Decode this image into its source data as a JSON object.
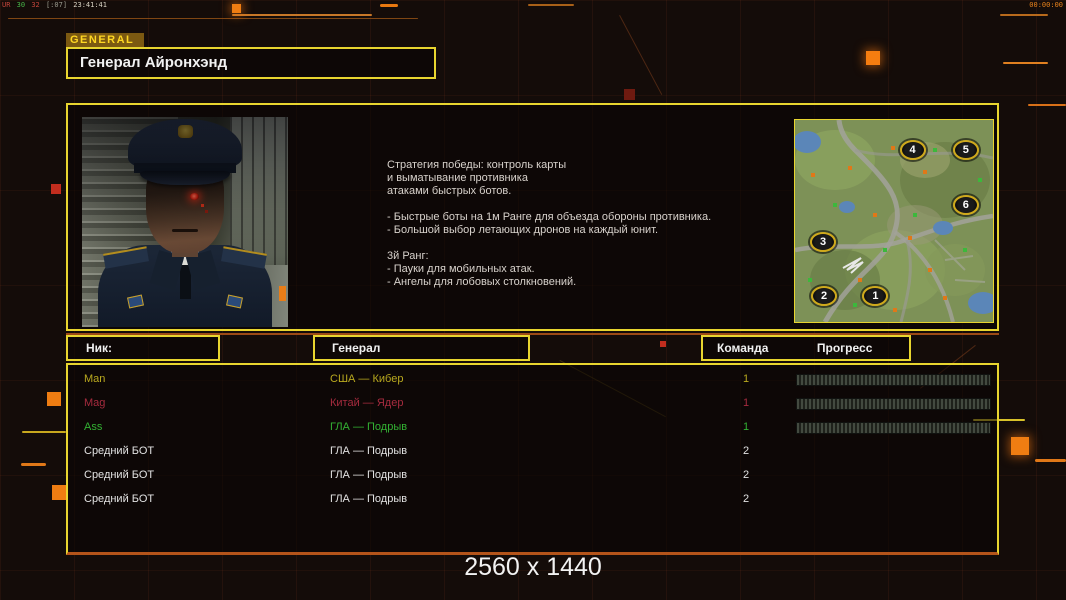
{
  "hud": {
    "debug": {
      "segments": [
        {
          "t": "UR",
          "c": "#c2453a"
        },
        {
          "t": "30",
          "c": "#49b649"
        },
        {
          "t": "32",
          "c": "#c2453a"
        },
        {
          "t": "[:07]",
          "c": "#9a9a8e"
        },
        {
          "t": "23:41:41",
          "c": "#d8d2c2"
        }
      ]
    },
    "clock": "00:00:00"
  },
  "header": {
    "tab": "GENERAL",
    "title": "Генерал Айронхэнд"
  },
  "briefing": {
    "lines": [
      "Стратегия победы: контроль карты",
      "и выматывание противника",
      "атаками быстрых ботов.",
      "",
      "- Быстрые боты на 1м Ранге для объезда обороны противника.",
      "- Большой выбор летающих дронов на каждый юнит.",
      "",
      "3й Ранг:",
      "- Пауки для мобильных атак.",
      "- Ангелы для лобовых столкновений."
    ]
  },
  "minimap": {
    "spawns": [
      {
        "n": "1"
      },
      {
        "n": "2"
      },
      {
        "n": "3"
      },
      {
        "n": "4"
      },
      {
        "n": "5"
      },
      {
        "n": "6"
      }
    ]
  },
  "table": {
    "headers": {
      "nick": "Ник:",
      "general": "Генерал",
      "team": "Команда",
      "progress": "Прогресс"
    },
    "rows": [
      {
        "nick": "Man",
        "general": "США — Кибер",
        "team": "1",
        "color": "#b9a91f"
      },
      {
        "nick": "Mag",
        "general": "Китай — Ядер",
        "team": "1",
        "color": "#a62b3e"
      },
      {
        "nick": "Ass",
        "general": "ГЛА — Подрыв",
        "team": "1",
        "color": "#33b233"
      },
      {
        "nick": "Средний БОТ",
        "general": "ГЛА — Подрыв",
        "team": "2",
        "color": "#e2e2e2"
      },
      {
        "nick": "Средний БОТ",
        "general": "ГЛА — Подрыв",
        "team": "2",
        "color": "#e2e2e2"
      },
      {
        "nick": "Средний БОТ",
        "general": "ГЛА — Подрыв",
        "team": "2",
        "color": "#e2e2e2"
      }
    ]
  },
  "footer": {
    "resolution": "2560 x 1440"
  },
  "colors": {
    "accent_yellow": "#e8d52f",
    "accent_orange": "#ef7d12",
    "background": "#140c09",
    "bar_segment": "#434a40"
  }
}
